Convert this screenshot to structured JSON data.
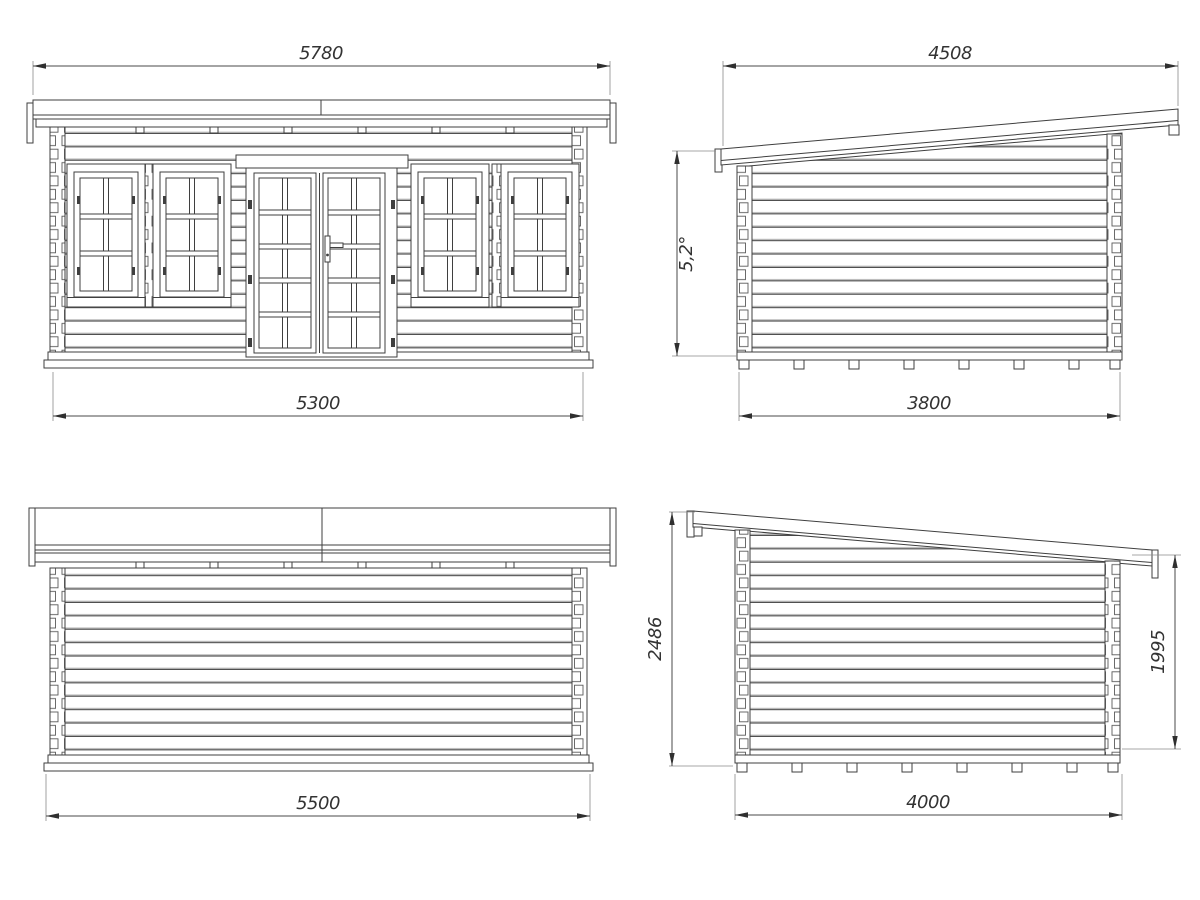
{
  "drawing": {
    "accent_color": "#3f3f3f",
    "views": {
      "front_elevation": {
        "overall_width": "5780",
        "wall_width": "5300"
      },
      "side_elevation_a": {
        "overall_depth": "4508",
        "roof_angle": "5,2°",
        "wall_depth": "3800"
      },
      "back_elevation": {
        "base_width": "5500"
      },
      "side_elevation_b": {
        "overall_height": "2486",
        "eave_height": "1995",
        "base_depth": "4000"
      }
    }
  }
}
